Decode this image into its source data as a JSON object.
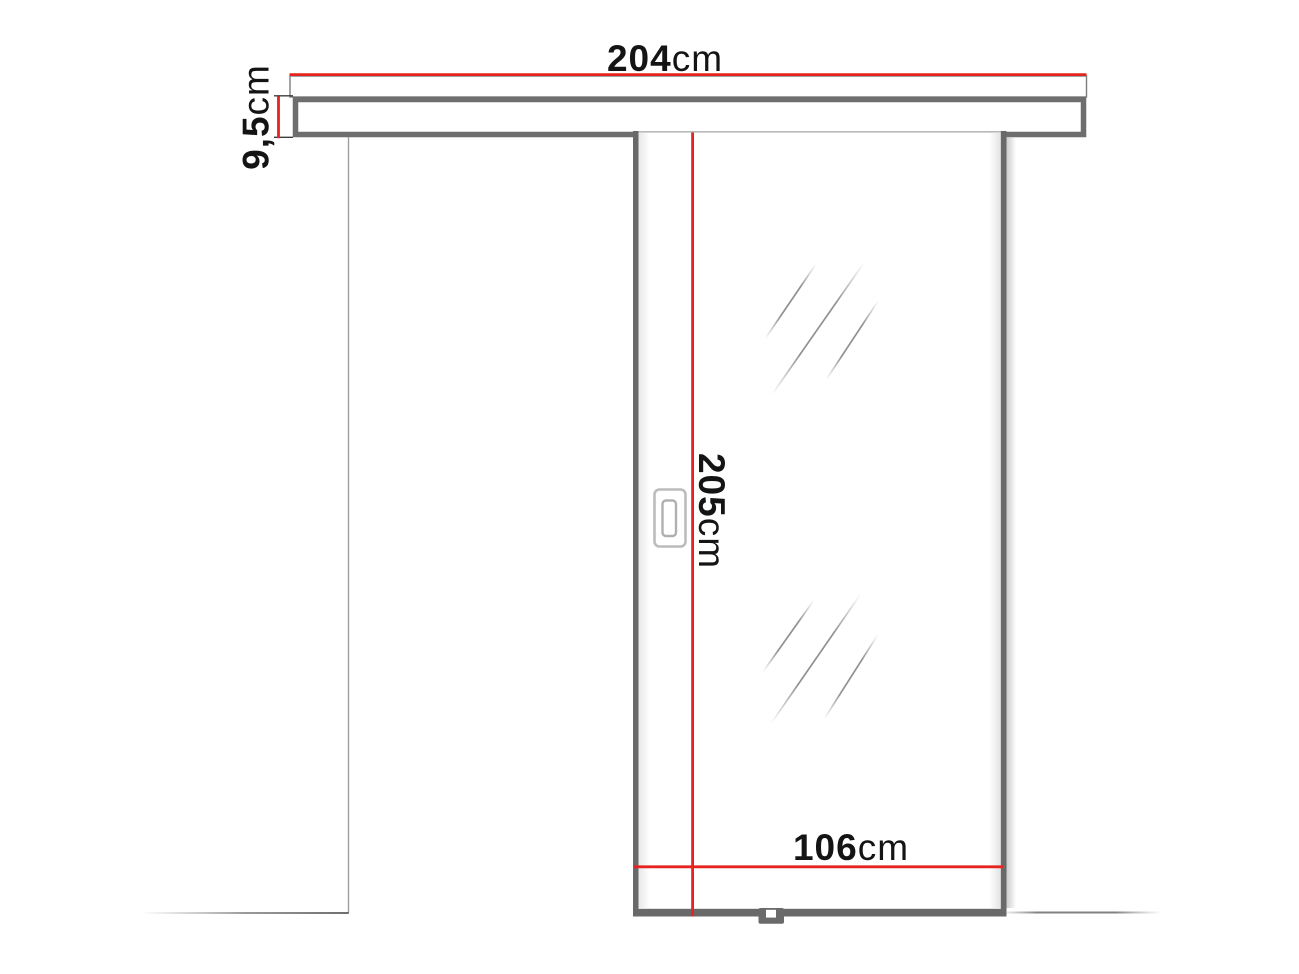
{
  "diagram": {
    "subject": "sliding-door-dimension-drawing",
    "dimensions": {
      "track_width": {
        "value": "204",
        "unit": "cm"
      },
      "track_height": {
        "value": "9,5",
        "unit": "cm"
      },
      "door_height": {
        "value": "205",
        "unit": "cm"
      },
      "door_width": {
        "value": "106",
        "unit": "cm"
      }
    },
    "colors": {
      "dimension_line": "#e6231e",
      "frame_dark": "#696969",
      "frame_mid": "#7d7d7d",
      "frame_light": "#b9b9b9",
      "text": "#141414",
      "background": "#ffffff"
    }
  }
}
